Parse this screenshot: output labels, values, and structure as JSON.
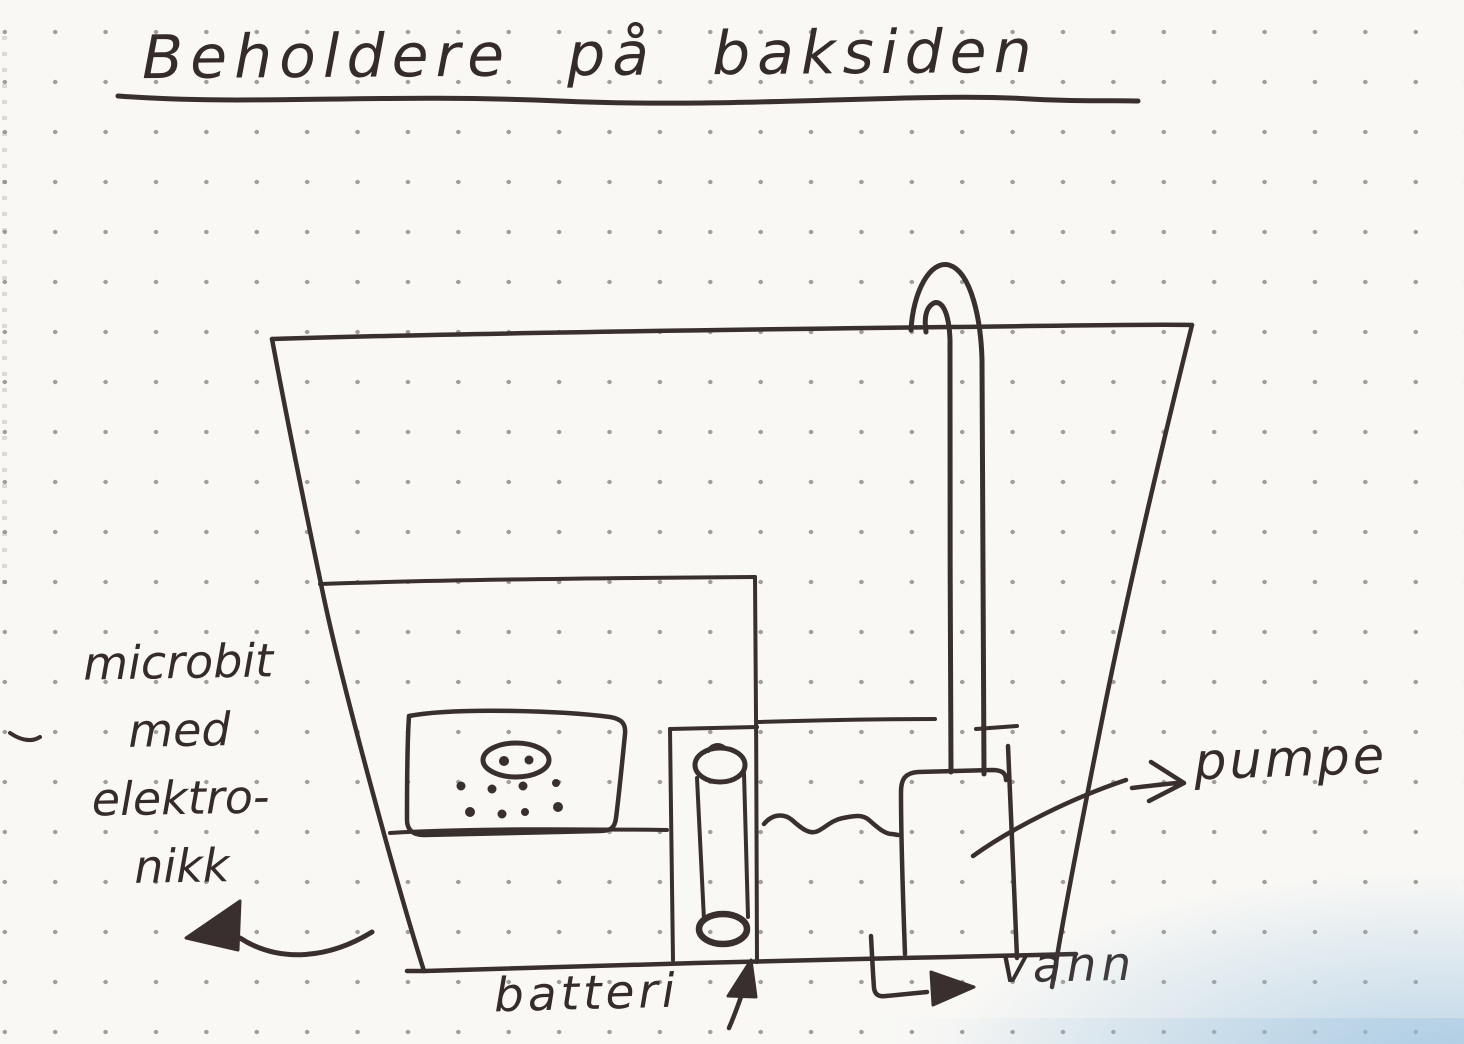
{
  "page": {
    "title": "Beholdere på baksiden",
    "description": "Hand-drawn sketch on dotted notebook paper showing containers on the back side of a device"
  },
  "labels": {
    "microbit": {
      "lines": [
        "microbit",
        "med",
        "elektro-",
        "nikk"
      ]
    },
    "batteri": "batteri",
    "pumpe": "pumpe",
    "vann": "vann"
  },
  "diagram": {
    "components": [
      {
        "name": "outer-container",
        "shape": "trapezoid open-top container"
      },
      {
        "name": "electronics-compartment",
        "shape": "inner rectangle holding microbit board"
      },
      {
        "name": "microbit-board",
        "shape": "rounded box with oval speaker and button dots"
      },
      {
        "name": "battery-compartment",
        "shape": "narrow vertical box with cylindrical battery"
      },
      {
        "name": "water-compartment",
        "shape": "section with wavy water line"
      },
      {
        "name": "pump-box",
        "shape": "rounded box at bottom of tube"
      },
      {
        "name": "hose-tube",
        "shape": "double-line tube hooked over container rim"
      }
    ],
    "arrows": [
      {
        "name": "microbit-arrow",
        "points_to": "electronics-compartment",
        "label": "microbit med elektro-nikk"
      },
      {
        "name": "batteri-arrow",
        "points_to": "battery-compartment",
        "label": "batteri"
      },
      {
        "name": "pumpe-arrow",
        "points_to": "pump-box",
        "label": "pumpe"
      },
      {
        "name": "vann-arrow",
        "points_to": "water-compartment",
        "label": "vann"
      }
    ]
  },
  "colors": {
    "ink": "#3a2f2f",
    "paper": "#f9f8f5",
    "grid_dot": "#a29e98",
    "scan_blue": "#94bede"
  }
}
